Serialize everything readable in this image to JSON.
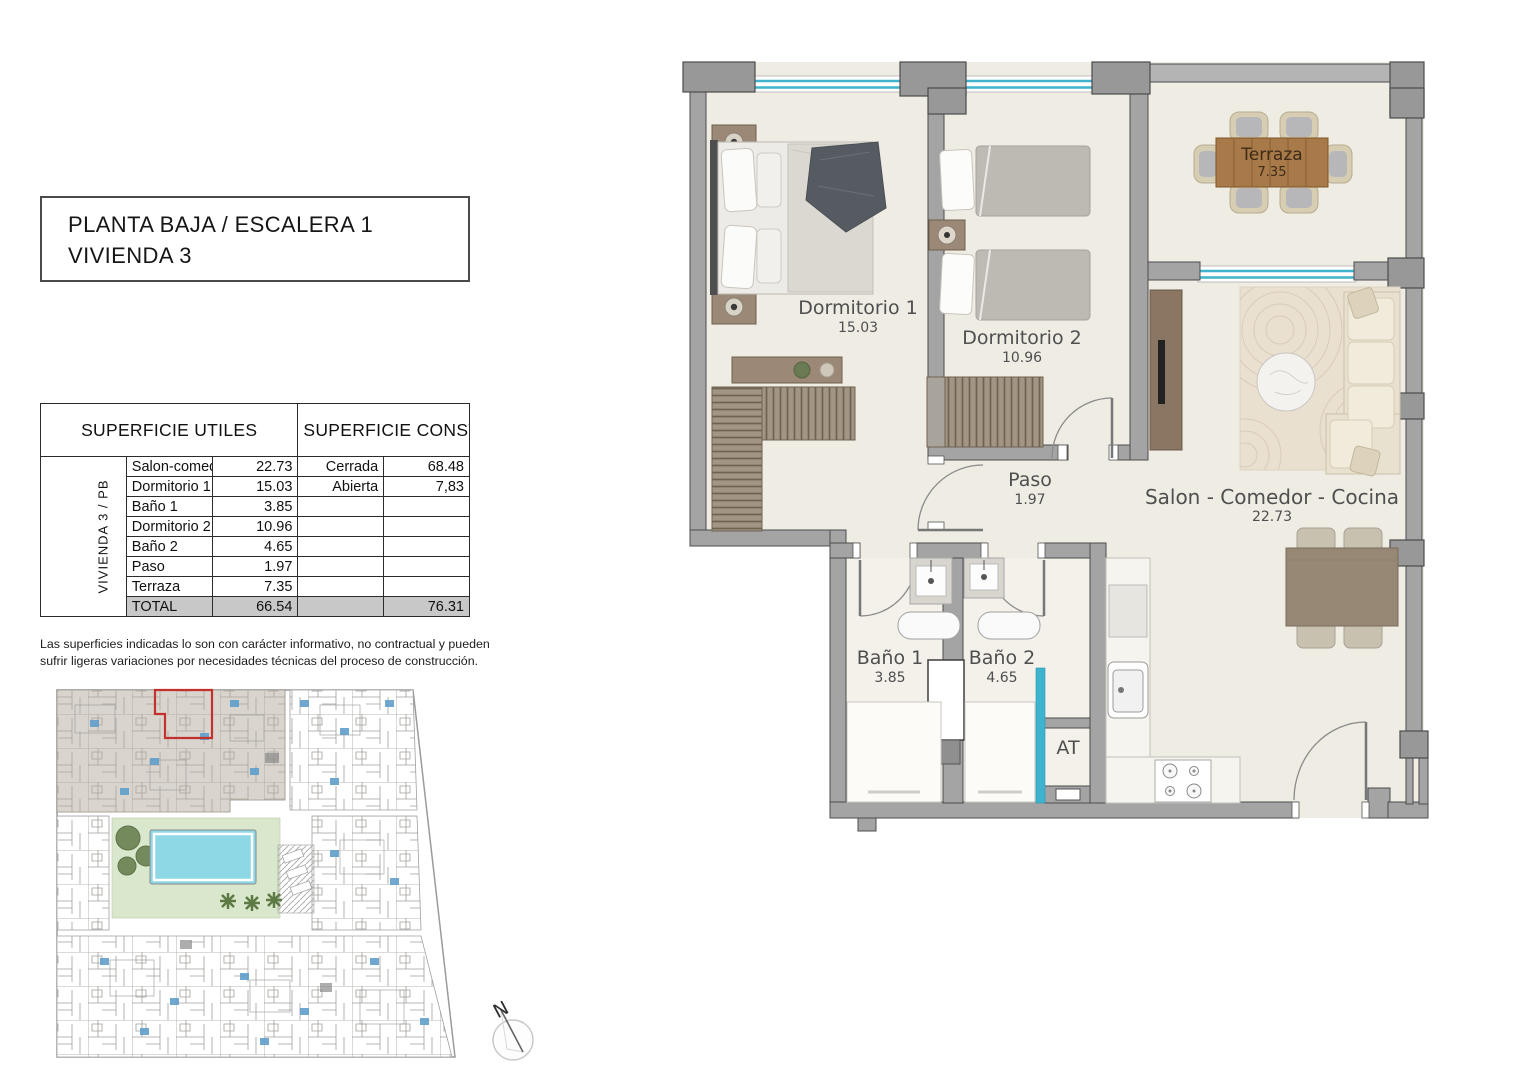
{
  "title": {
    "line1": "PLANTA BAJA / ESCALERA 1",
    "line2": "VIVIENDA 3"
  },
  "areas_table": {
    "header_utiles": "SUPERFICIE UTILES",
    "header_construidas": "SUPERFICIE CONSTRUIDAS",
    "vertical_label": "VIVIENDA 3 / PB",
    "rows": [
      {
        "name": "Salon-comedor-cocina",
        "value": "22.73",
        "built_label": "Cerrada",
        "built_value": "68.48"
      },
      {
        "name": "Dormitorio 1",
        "value": "15.03",
        "built_label": "Abierta",
        "built_value": "7,83"
      },
      {
        "name": "Baño 1",
        "value": "3.85",
        "built_label": "",
        "built_value": ""
      },
      {
        "name": "Dormitorio 2",
        "value": "10.96",
        "built_label": "",
        "built_value": ""
      },
      {
        "name": "Baño 2",
        "value": "4.65",
        "built_label": "",
        "built_value": ""
      },
      {
        "name": "Paso",
        "value": "1.97",
        "built_label": "",
        "built_value": ""
      },
      {
        "name": "Terraza",
        "value": "7.35",
        "built_label": "",
        "built_value": ""
      }
    ],
    "total_row": {
      "name": "TOTAL",
      "value": "66.54",
      "built_value": "76.31"
    }
  },
  "disclaimer": "Las superficies indicadas lo son con carácter informativo, no contractual y pueden sufrir ligeras variaciones por necesidades técnicas del proceso de construcción.",
  "floorplan": {
    "rooms": {
      "dormitorio1": {
        "name": "Dormitorio 1",
        "area": "15.03"
      },
      "dormitorio2": {
        "name": "Dormitorio 2",
        "area": "10.96"
      },
      "terraza": {
        "name": "Terraza",
        "area": "7.35"
      },
      "paso": {
        "name": "Paso",
        "area": "1.97"
      },
      "salon": {
        "name": "Salon - Comedor - Cocina",
        "area": "22.73"
      },
      "bano1": {
        "name": "Baño 1",
        "area": "3.85"
      },
      "bano2": {
        "name": "Baño 2",
        "area": "4.65"
      },
      "at": {
        "name": "AT"
      }
    }
  },
  "compass": {
    "label": "N"
  },
  "colors": {
    "wall": "#a4a4a4",
    "wall_outline": "#4c4c4c",
    "floor": "#efece4",
    "window": "#3fb4cc",
    "highlight_red": "#c3312f",
    "pool": "#8ed8e6",
    "courtyard_green": "#d9e7cc",
    "site_block_gray": "#b3aa9c"
  }
}
